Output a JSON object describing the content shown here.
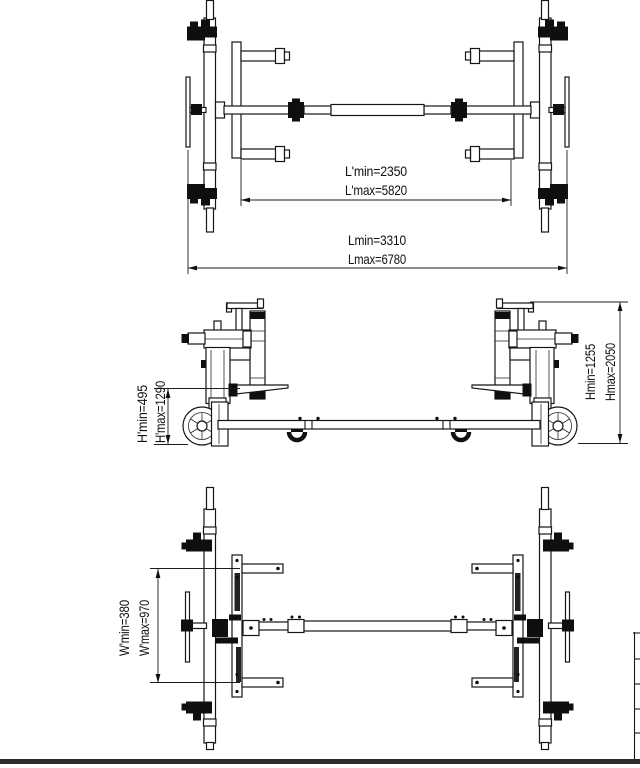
{
  "colors": {
    "ink": "#161616",
    "background": "#ffffff"
  },
  "views": {
    "top_plan": {
      "dims": {
        "inner_length_min": "L'min=2350",
        "inner_length_max": "L'max=5820",
        "overall_length_min": "Lmin=3310",
        "overall_length_max": "Lmax=6780"
      }
    },
    "side_elevation": {
      "dims": {
        "platform_height_min": "H'min=495",
        "platform_height_max": "H'max=1290",
        "overall_height_min": "Hmin=1255",
        "overall_height_max": "Hmax=2050"
      }
    },
    "bottom_plan": {
      "dims": {
        "arm_width_min": "W'min=380",
        "arm_width_max": "W'max=970"
      }
    }
  }
}
